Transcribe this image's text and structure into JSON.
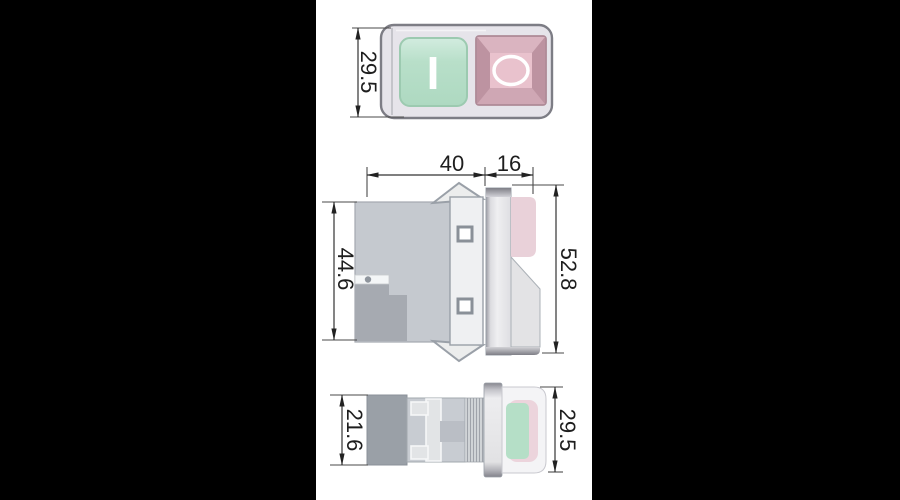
{
  "palette": {
    "background": "#000000",
    "paper": "#ffffff",
    "dimension_line": "#333333",
    "dimension_text": "#1e1e1e",
    "switch_body_gray": "#c5c9cf",
    "dark_gray_block": "#a6aab1",
    "mounting_panel": "#eff0f2",
    "green_button": "#b3dbc4",
    "green_button_border": "#9ccab0",
    "pink_button_center": "#e9c2cd",
    "pink_button_frame": "#c9a0ad",
    "symbol_white": "#ffffff"
  },
  "views": {
    "top_view": {
      "height_dim": "29.5",
      "on_button_symbol": "I",
      "off_button_symbol": "O"
    },
    "side_view": {
      "body_width_dim": "40",
      "bezel_depth_dim": "16",
      "body_height_dim": "44.6",
      "overall_height_dim": "52.8"
    },
    "bottom_view": {
      "rear_depth_dim": "21.6",
      "bezel_height_dim": "29.5"
    }
  }
}
